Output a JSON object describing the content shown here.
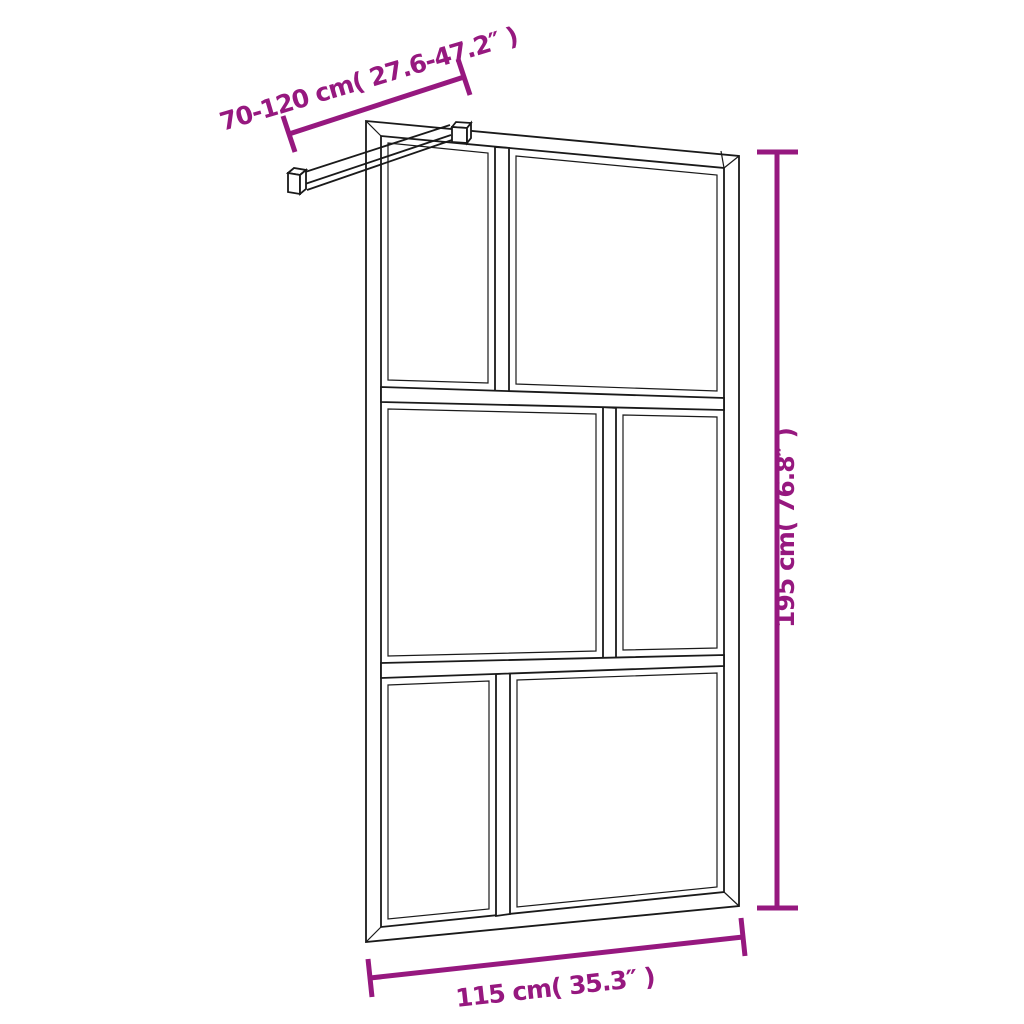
{
  "diagram": {
    "background_color": "#ffffff",
    "line_color": "#1a1a1a",
    "dimension_color": "#96187f",
    "dimensions": {
      "support_bar_range": {
        "label": "70-120 cm( 27.6-47.2″ )",
        "cm": "70-120 cm",
        "inches": "27.6-47.2″"
      },
      "height": {
        "label": "195 cm( 76.8″ )",
        "cm": "195 cm",
        "inches": "76.8″"
      },
      "width": {
        "label": "115 cm( 35.3″ )",
        "cm": "115 cm",
        "inches": "35.3″"
      }
    }
  }
}
